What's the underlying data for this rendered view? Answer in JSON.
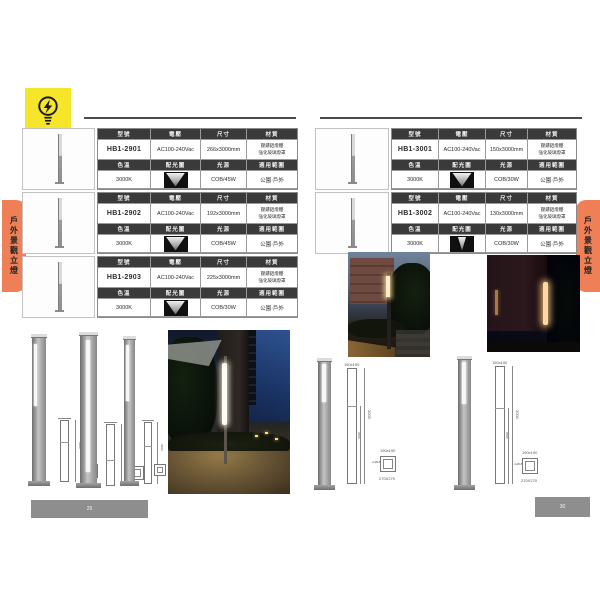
{
  "tab_label": "戶外景觀立燈",
  "page_numbers": {
    "left": "29",
    "right": "30"
  },
  "headers": {
    "model": "型號",
    "voltage": "電壓",
    "size": "尺寸",
    "material": "材質",
    "color_temp": "色溫",
    "distribution": "配光圖",
    "light_source": "光源",
    "application": "適用範圍"
  },
  "products": [
    {
      "model": "HB1-2901",
      "voltage": "AC100-240Vac",
      "size": "266x3000mm",
      "material_1": "壓鑄鋁燈體",
      "material_2": "強化玻璃燈罩",
      "color_temp": "3000K",
      "light_source": "COB/45W",
      "application": "公園·戶外"
    },
    {
      "model": "HB1-2902",
      "voltage": "AC100-240Vac",
      "size": "192x3000mm",
      "material_1": "壓鑄鋁燈體",
      "material_2": "強化玻璃燈罩",
      "color_temp": "3000K",
      "light_source": "COB/45W",
      "application": "公園·戶外"
    },
    {
      "model": "HB1-2903",
      "voltage": "AC100-240Vac",
      "size": "225x3000mm",
      "material_1": "壓鑄鋁燈體",
      "material_2": "強化玻璃燈罩",
      "color_temp": "3000K",
      "light_source": "COB/30W",
      "application": "公園·戶外"
    },
    {
      "model": "HB1-3001",
      "voltage": "AC100-240Vac",
      "size": "150x3000mm",
      "material_1": "壓鑄鋁燈體",
      "material_2": "強化玻璃燈罩",
      "color_temp": "3000K",
      "light_source": "COB/30W",
      "application": "公園·戶外"
    },
    {
      "model": "HB1-3002",
      "voltage": "AC100-240Vac",
      "size": "130x3000mm",
      "material_1": "壓鑄鋁燈體",
      "material_2": "強化玻璃燈罩",
      "color_temp": "3000K",
      "light_source": "COB/30W",
      "application": "公園·戶外"
    }
  ],
  "dimensions": {
    "top": "150x150",
    "height": "3000",
    "lamp": "2500",
    "base": "190x190",
    "bolt": "4-Ø18",
    "plate": "270X270"
  },
  "colors": {
    "accent_orange": "#EE7F56",
    "logo_yellow": "#F6E62B",
    "table_header_bg": "#3A3A3A",
    "page_bar_gray": "#8E8E8E"
  }
}
